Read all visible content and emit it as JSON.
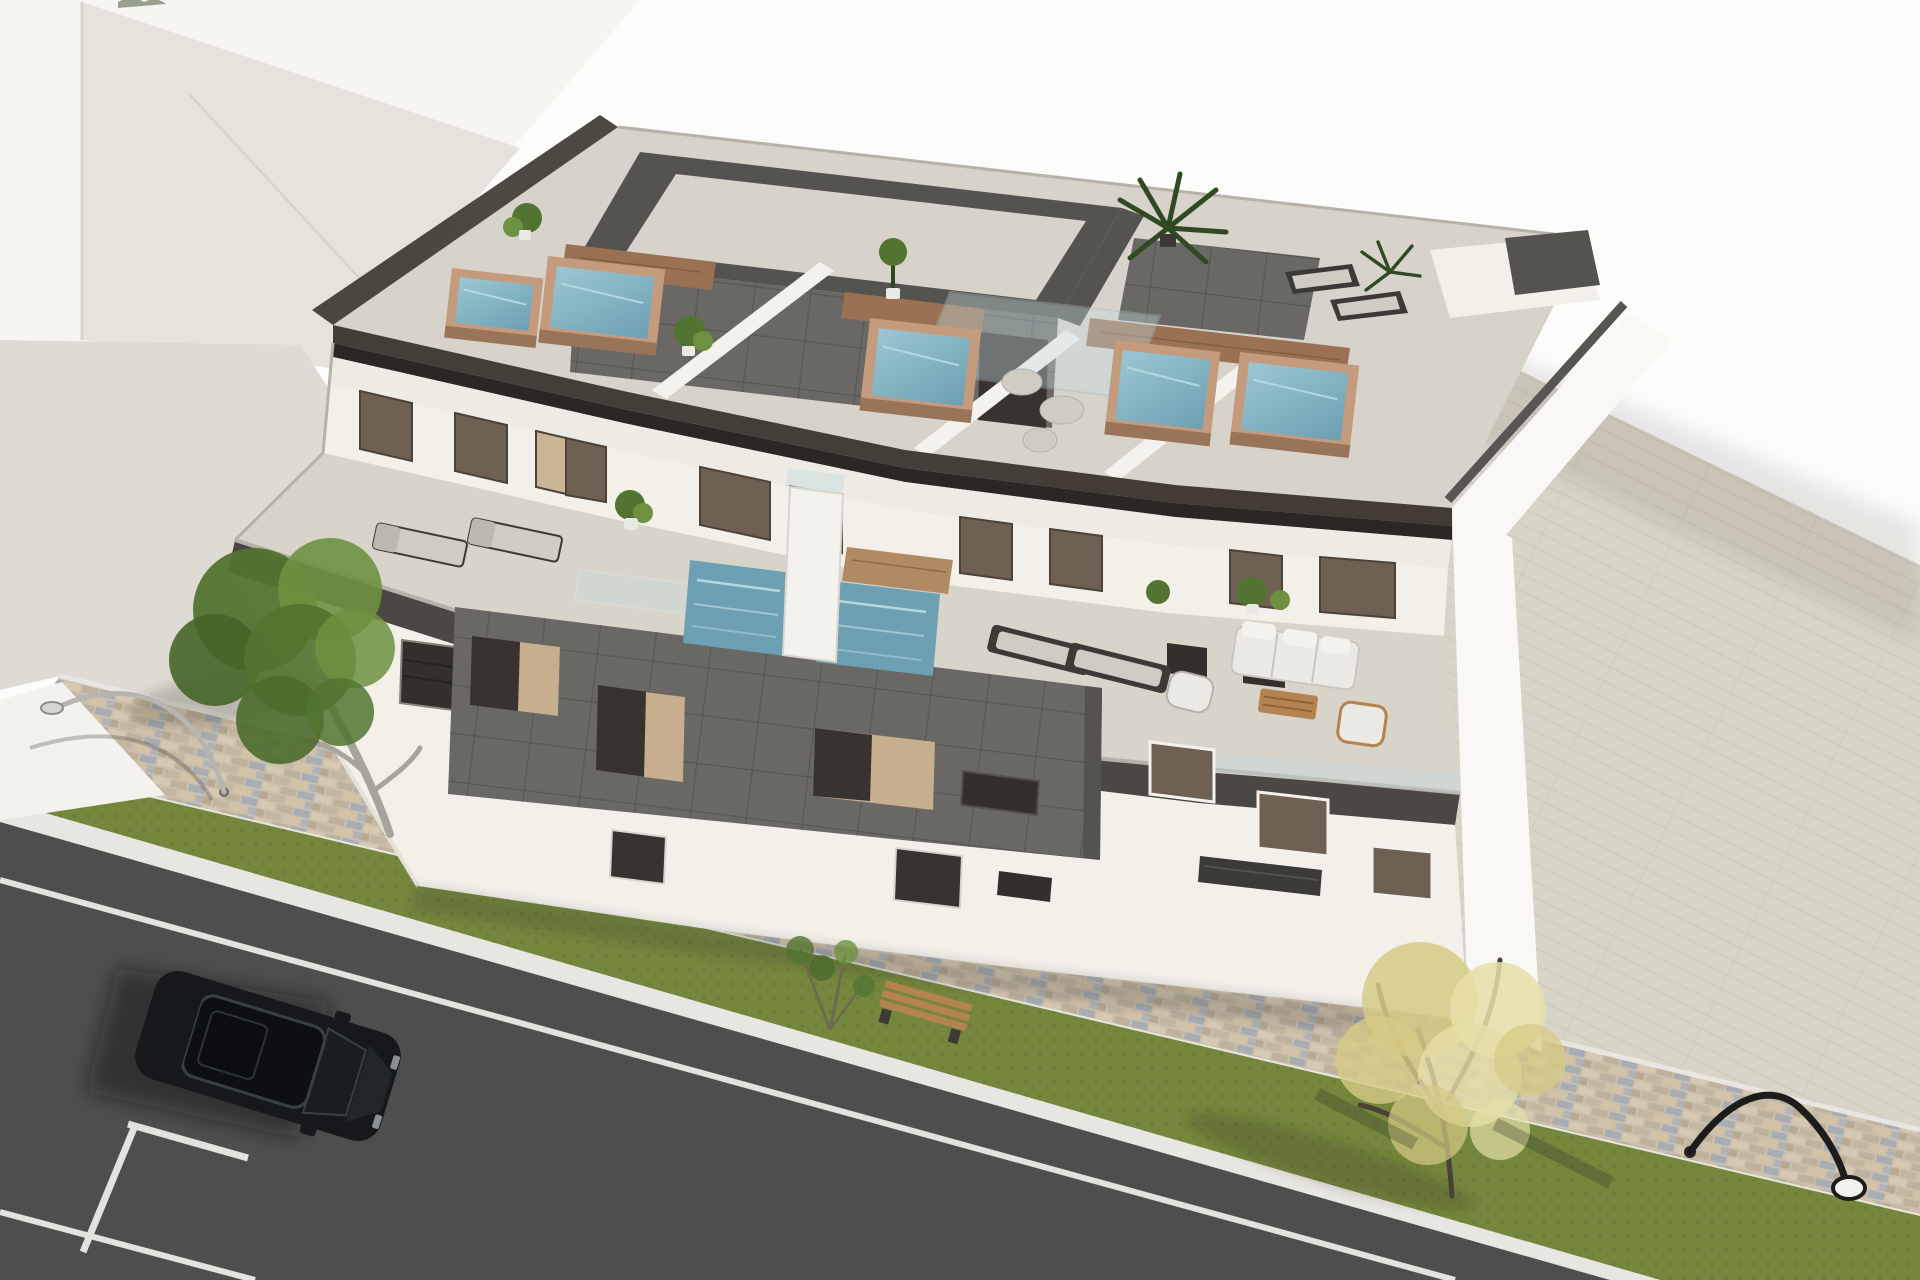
{
  "meta": {
    "type": "3d-architectural-render",
    "subject": "Aerial render of a modern three-storey apartment building with rooftop jacuzzi solarium, terraces and street frontage",
    "width_px": 1920,
    "height_px": 1280
  },
  "palette": {
    "sky": "#fcfcfb",
    "neighbor_roof": "#e7e3dc",
    "neighbor_wall": "#f6f5f1",
    "ground_left": "#dedbd4",
    "ground_right": "#d9d4c8",
    "ground_right_line": "#ccc6b9",
    "path_white": "#f3f2ee",
    "curb": "#e8e6e1",
    "grass": "#75873d",
    "grass_dark": "#5e7030",
    "road": "#4e4e4e",
    "road_mark": "#e3e2de",
    "wall_white": "#f2f0e9",
    "wall_bright": "#f9f8f5",
    "wall_shade": "#e4e1d9",
    "fascia": "#edebe4",
    "parapet_glass": "#3a342d",
    "parapet_dark": "#2b2723",
    "terrace_floor": "#d8d4c9",
    "terrace_parapet": "#4b4742",
    "coping": "#b6b2aa",
    "tile_dark": "#6a6865",
    "tile_grid": "#585653",
    "tile_box_top": "#55534f",
    "reveal_tan": "#c6ae8e",
    "opening_dark": "#37342f",
    "window_bronze": "#6e6154",
    "window_dark": "#332f2b",
    "window_frame": "#8a8178",
    "curtain_tan": "#c9b495",
    "water": "#8fbccb",
    "water_deep": "#6ca0b2",
    "water_light": "#b5d8e0",
    "brick": "#c59b7d",
    "brick_dark": "#9a7458",
    "wood": "#9a7253",
    "wood_light": "#b08a63",
    "deck_light": "#d7d3ca",
    "divider_white": "#f4f2ec",
    "glass_blue": "#c7dbe2",
    "plant_green": "#527430",
    "plant_light": "#6d9140",
    "palm_dark": "#2f4a22",
    "pouf": "#cfccc4",
    "furn_frame": "#3b3a36",
    "cushion": "#ebe9e3",
    "table_wood": "#b5834f",
    "tree_yellow": "#d6cb85",
    "tree_yellow_light": "#e6dfa8",
    "trunk_dark": "#4a4236",
    "trunk_silver": "#a8a49c",
    "lamp_silver": "#b7b5b0",
    "lamp_black": "#1d1c1a",
    "car_body": "#16181b",
    "car_glass": "#0d0f12",
    "car_trim": "#3a3f45"
  },
  "scene": {
    "background": {
      "sky": "white backdrop",
      "neighbor_building": "white flat-roof building mass, upper left",
      "paved_yard_right": "beige running-bond paving, right side",
      "paved_ground_left": "light grey paving, left side"
    },
    "building": {
      "storeys": 3,
      "style": "modern white render with dark grey tile feature panels and smoked-glass balustrades",
      "roof_solarium": {
        "jacuzzis": 5,
        "jacuzzi_finish": "brick-clad base with blue water",
        "penthouse_core": "dark grey tiled box with recessed roof",
        "glass_pergola": 1,
        "white_party_walls": 3,
        "potted_plants": 4,
        "palm_plants": 2,
        "sun_loungers": 2,
        "poufs": 3,
        "wood_decking": true
      },
      "middle_floor_terrace": {
        "plunge_pools": 2,
        "sun_loungers": 4,
        "sofa_set": 1,
        "armchairs": 2,
        "coffee_table": 1,
        "potted_plants": 4,
        "sliding_glass_doors": 9
      },
      "ground_floor": {
        "doors": 2,
        "windows": 6,
        "balconies": 1
      }
    },
    "street": {
      "road": "dark asphalt with white lane line and parking-bay T markings",
      "parked_cars": 1,
      "car_color": "black",
      "sidewalk": "multicolour cobble paver band",
      "grass_verge": true,
      "benches": 1,
      "street_lamps": 2,
      "trees": [
        {
          "position": "left",
          "foliage": "green"
        },
        {
          "position": "bottom-right",
          "foliage": "yellow"
        }
      ]
    }
  }
}
